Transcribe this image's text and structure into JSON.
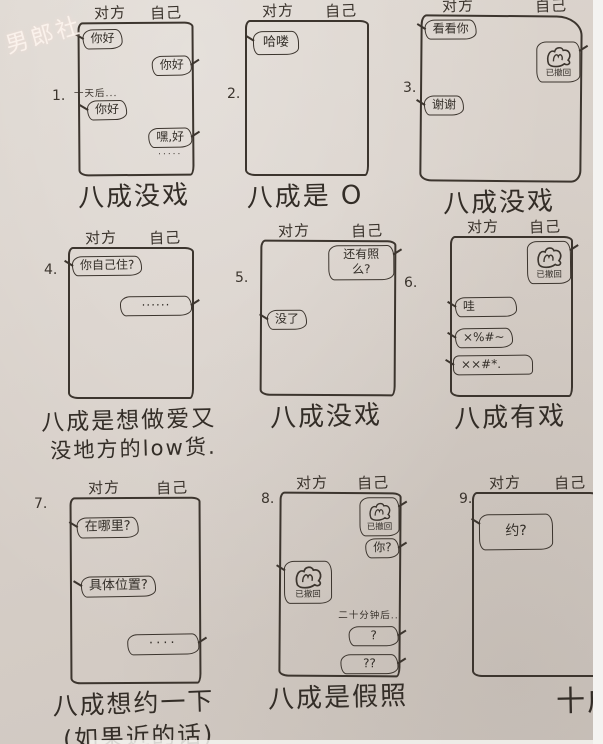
{
  "watermark": "男郎社",
  "header_left": "对方",
  "header_right": "自己",
  "panels": [
    {
      "number": "1.",
      "caption": "八成没戏",
      "messages": [
        {
          "side": "left",
          "text": "你好"
        },
        {
          "side": "right",
          "text": "你好"
        },
        {
          "side": "center",
          "text": "一天后..."
        },
        {
          "side": "left",
          "text": "你好"
        },
        {
          "side": "right",
          "text": "嘿,好",
          "sub": "·····"
        }
      ]
    },
    {
      "number": "2.",
      "caption": "八成是 O",
      "messages": [
        {
          "side": "left",
          "text": "哈喽"
        }
      ]
    },
    {
      "number": "3.",
      "caption": "八成没戏",
      "messages": [
        {
          "side": "left",
          "text": "看看你"
        },
        {
          "side": "right",
          "photo": true,
          "text": "已撤回"
        },
        {
          "side": "left",
          "text": "谢谢"
        }
      ]
    },
    {
      "number": "4.",
      "caption": "八成是想做爱又",
      "caption2": "没地方的low货.",
      "messages": [
        {
          "side": "left",
          "text": "你自己住?"
        },
        {
          "side": "right",
          "text": "······"
        }
      ]
    },
    {
      "number": "5.",
      "caption": "八成没戏",
      "messages": [
        {
          "side": "right",
          "text": "还有照么?"
        },
        {
          "side": "left",
          "text": "没了"
        }
      ]
    },
    {
      "number": "6.",
      "caption": "八成有戏",
      "messages": [
        {
          "side": "right",
          "photo": true,
          "text": "已撤回"
        },
        {
          "side": "left",
          "text": "哇"
        },
        {
          "side": "left",
          "text": "×%#~"
        },
        {
          "side": "left",
          "text": "××#*."
        }
      ]
    },
    {
      "number": "7.",
      "caption": "八成想约一下",
      "caption2": "(如果近的话)",
      "messages": [
        {
          "side": "left",
          "text": "在哪里?"
        },
        {
          "side": "left",
          "text": "具体位置?"
        },
        {
          "side": "right",
          "text": "····"
        }
      ]
    },
    {
      "number": "8.",
      "caption": "八成是假照",
      "messages": [
        {
          "side": "right",
          "photo": true,
          "text": "已撤回"
        },
        {
          "side": "right",
          "text": "你?"
        },
        {
          "side": "left",
          "photo": true,
          "text": "已撤回"
        },
        {
          "side": "center",
          "text": "二十分钟后.."
        },
        {
          "side": "right",
          "text": "?"
        },
        {
          "side": "right",
          "text": "??"
        }
      ]
    },
    {
      "number": "9.",
      "caption": "十成是SB",
      "messages": [
        {
          "side": "left",
          "text": "约?"
        }
      ]
    }
  ]
}
